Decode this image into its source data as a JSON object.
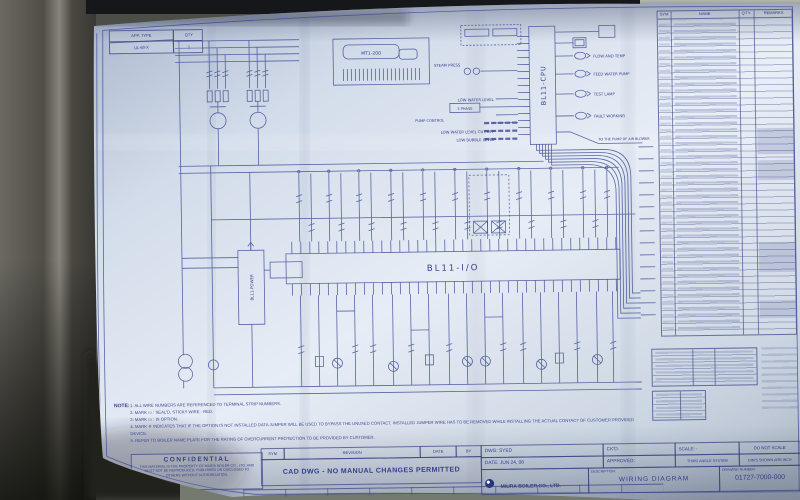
{
  "paper": {
    "approval_table": {
      "header_left": "APP. TYPE",
      "header_right": "QTY",
      "value": "UL-60-X",
      "qty": "1"
    },
    "connector_label": "MT1-200",
    "cpu": {
      "label": "BL11-CPU",
      "inputs": [
        "STEAM PRESS",
        "LOW WATER LEVEL",
        "3 PHASE",
        "PUMP CONTROL",
        "LOW WATER LEVEL CUT OFF",
        "LOW BUBBLE LEVEL"
      ],
      "outputs": [
        "FLOW AND TEMP",
        "FEED WATER PUMP",
        "TEST LAMP",
        "FAULT WORKING",
        "TO THE PUMP OF AIR BLOWER"
      ]
    },
    "io_label": "BL11-I/O",
    "power_label": "BL11-POWER",
    "legend_table": {
      "headers": [
        "SYM",
        "NAME",
        "Q'TY",
        "REMARKS"
      ]
    },
    "notes": {
      "label": "NOTE:",
      "items": [
        "1.  ALL WIRE NUMBERS ARE REFERENCED TO TERMINAL STRIP NUMBERS.",
        "2.  MARK ▭ : SEAL'D, STICKY WIRE - RED.",
        "3.  MARK ▭ : IS OPTION.",
        "4.  MARK ※ INDICATES THAT IF THE OPTION IS NOT INSTALLED DATA JUMPER WILL BE USED TO BYPASS THE UNUSED CONTACT. INSTALLED JUMPER WIRE HAS TO BE REMOVED WHILE INSTALLING THE ACTUAL CONTACT OF CUSTOMER PROVIDED DEVICE.",
        "5.  REFER TO BOILER NAME PLATE FOR THE RATING OF OVERCURRENT PROTECTION TO BE PROVIDED BY CUSTOMER."
      ]
    },
    "confidential": {
      "title": "CONFIDENTIAL",
      "body": "THIS MATERIAL IS THE PROPERTY OF MIURA BOILER CO., LTD. AND MUST NOT BE REPRODUCED, PUBLISHED OR DISCLOSED TO OTHERS WITHOUT AUTHORIZATION."
    },
    "revision": {
      "sym": "SYM",
      "revision": "REVISION",
      "date": "DATE",
      "by": "BY",
      "cad_note": "CAD DWG - NO MANUAL CHANGES PERMITTED"
    },
    "title_block": {
      "dwg": "DWG: SYED",
      "ckd": "CK'D:",
      "scale": "SCALE:       -",
      "do_not_scale": "DO NOT SCALE",
      "date": "DATE: JUN 24, 08",
      "approved": "APPROVED:",
      "third_angle": "THIRD ANGLE SYSTEM",
      "dims": "DIM'S SHOWN ARE INCH",
      "company": "MIURA BOILER CO., LTD.",
      "company_sub": "BRANTFORD, ONT.",
      "description_label": "DESCRIPTION:",
      "description": "WIRING DIAGRAM",
      "drawing_number_label": "DRAWING NUMBER",
      "drawing_number": "01727-7000-000"
    }
  },
  "colors": {
    "ink": "#33408a",
    "paper": "#e4eaf2"
  }
}
